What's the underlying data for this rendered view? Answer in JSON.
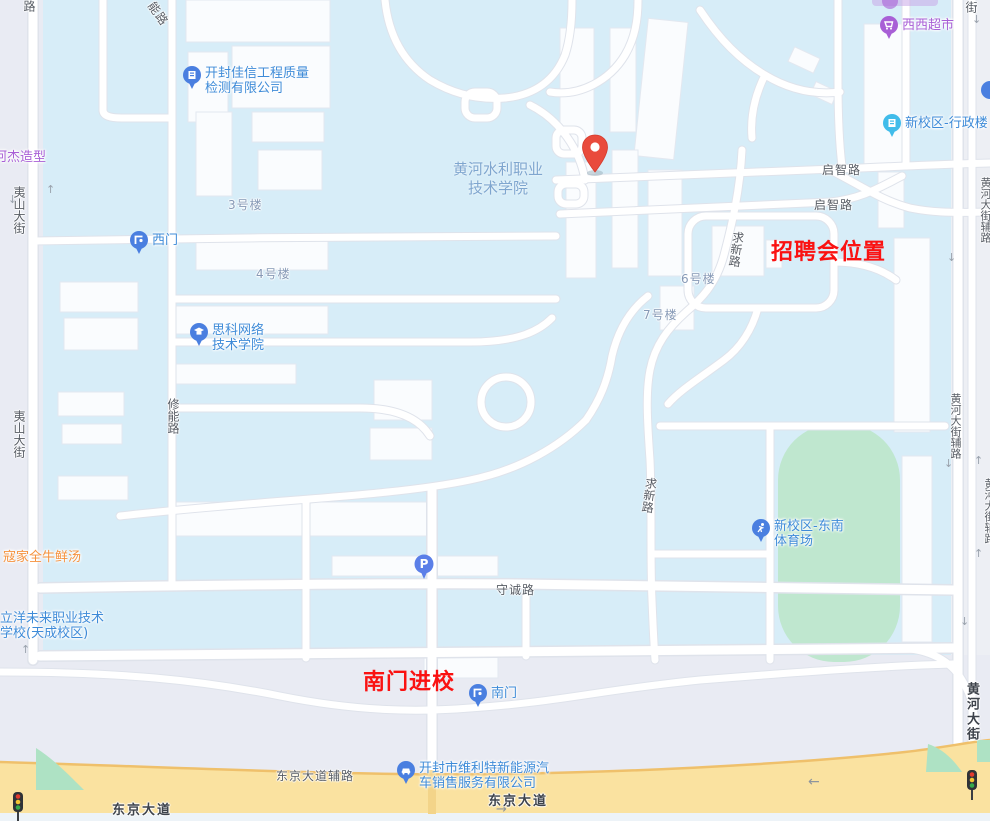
{
  "annotations": {
    "job_fair": "招聘会位置",
    "south_gate_entry": "南门进校"
  },
  "campus": {
    "line1": "黄河水利职业",
    "line2": "技术学院"
  },
  "road_labels": {
    "partial_top_left": "路",
    "neng_lu_diagonal": "能路",
    "yishan_street_1": "夷山大街",
    "yishan_street_2": "夷山大街",
    "xiuneng_road": "修能路",
    "qizhi_road_1": "启智路",
    "qizhi_road_2": "启智路",
    "qiuxin_road_1": "求新路",
    "qiuxin_road_2": "求新路",
    "shoucheng_road": "守诚路",
    "jie_top_right": "街",
    "huanghe_fulu_1": "黄河大街辅路",
    "huanghe_fulu_2": "黄河大街辅路",
    "huanghe_fulu_3": "黄河大街辅路",
    "huanghe_dajie": "黄河大街",
    "dongjing_fulu": "东京大道辅路",
    "dongjing_dadao_1": "东京大道",
    "dongjing_dadao_2": "东京大道"
  },
  "building_labels": {
    "b3": "3号楼",
    "b4": "4号楼",
    "b6": "6号楼",
    "b7": "7号楼"
  },
  "pois": {
    "jiaxin": {
      "line1": "开封佳信工程质量",
      "line2": "检测有限公司"
    },
    "west_gate": "西门",
    "sike": {
      "line1": "思科网络",
      "line2": "技术学院"
    },
    "xixi_market": "西西超市",
    "admin_building": "新校区-行政楼",
    "stadium": {
      "line1": "新校区-东南",
      "line2": "体育场"
    },
    "south_gate": "南门",
    "weilite": {
      "line1": "开封市维利特新能源汽",
      "line2": "车销售服务有限公司"
    },
    "hejie": "河杰造型",
    "koujia": "寇家全牛鲜汤",
    "liyang": {
      "line1": "立洋未来职业技术",
      "line2": "学校(天成校区)"
    },
    "parking": "P"
  },
  "colors": {
    "campus_fill": "#D7EDF8",
    "outside_road": "#E9EBF3",
    "highway_yellow": "#FAE2A0",
    "highway_border": "#EFC06B",
    "green_field": "#BFE7CF",
    "poi_blue": "#3E8BD8",
    "poi_purple": "#A85FD6",
    "poi_orange": "#F5923E",
    "annotation_red": "#FA1212",
    "pin_red": "#E94B3C",
    "gate_icon_blue": "#4A7FE0"
  }
}
